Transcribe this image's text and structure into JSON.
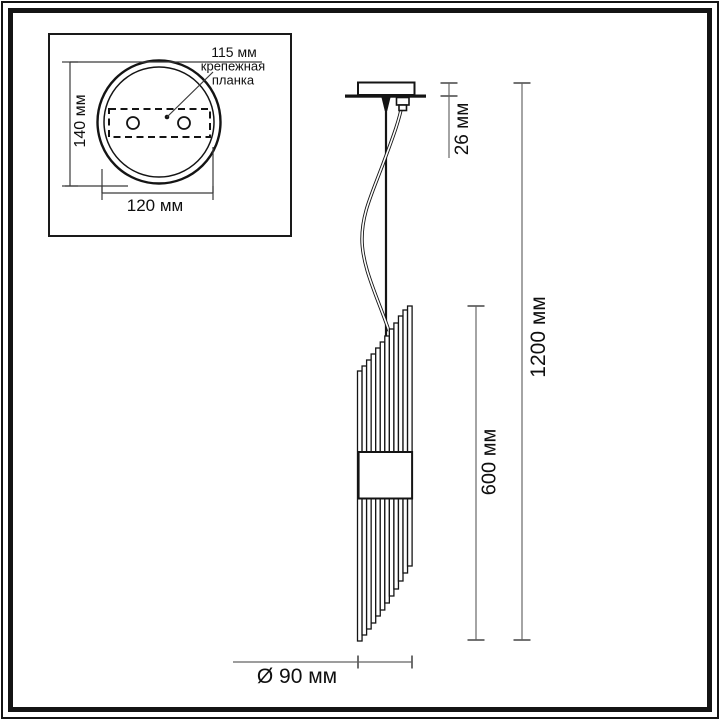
{
  "drawing": {
    "type": "pendant-lamp-dimension-diagram",
    "colors": {
      "line": "#141414",
      "dimension_line": "#7d7d7d",
      "tick": "#5f5f5f",
      "background": "#ffffff",
      "text": "#0f0f0f"
    }
  },
  "inset": {
    "top_dim": "115 мм",
    "mount_label": "крепежная\nпланка",
    "height_dim": "140 мм",
    "width_dim": "120 мм"
  },
  "main": {
    "canopy_offset_dim": "26 мм",
    "total_height_dim": "1200 мм",
    "body_height_dim": "600 мм",
    "diameter_dim": "Ø 90 мм"
  }
}
